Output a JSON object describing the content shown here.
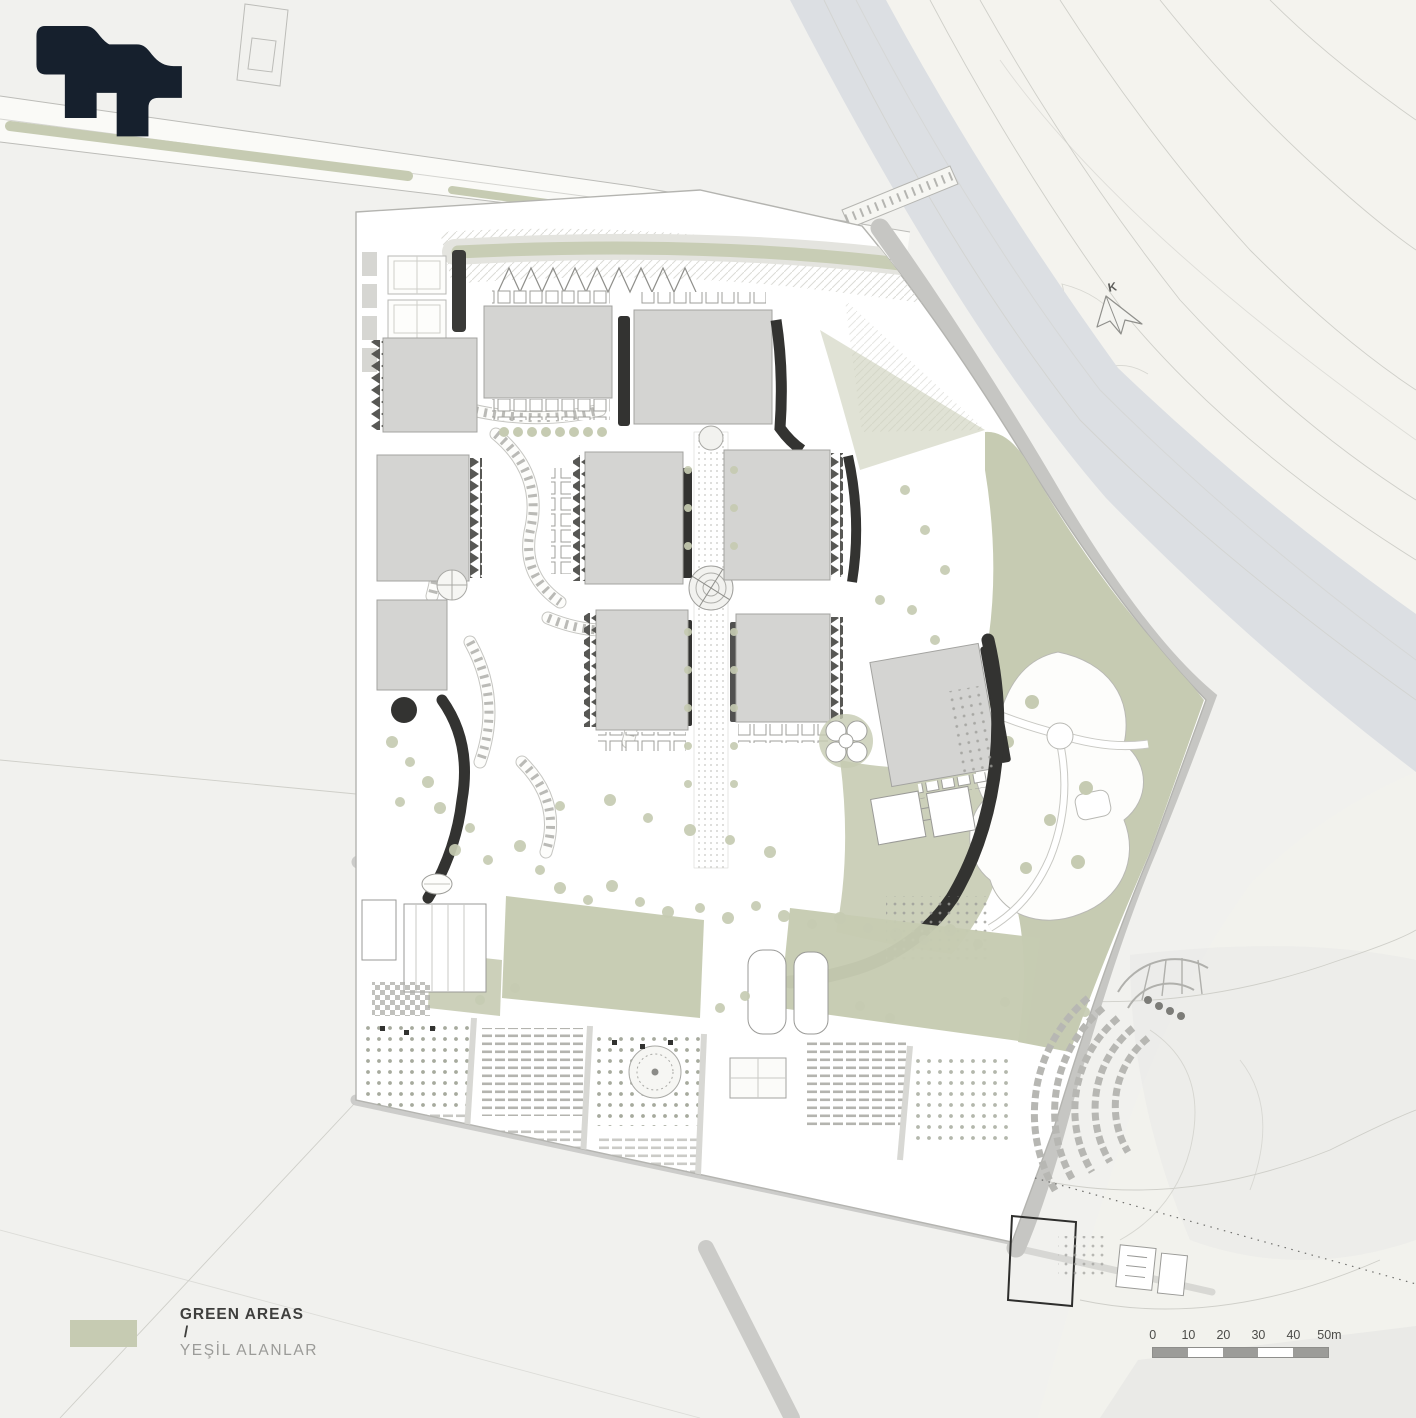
{
  "sheet": {
    "background": "#f1f1ee"
  },
  "palette": {
    "sheet_bg": "#f1f1ee",
    "logo_navy": "#16202d",
    "site_white": "#ffffff",
    "building_gray": "#d4d4d2",
    "building_outline": "#a3a3a0",
    "shadow_dark": "#333331",
    "green": "#c6cbb2",
    "road_gray": "#c6c6c3",
    "river_gray": "#dcdfe3",
    "terrain_cream": "#f4f3ee",
    "contour_line": "#cfcfc9",
    "text_dark": "#3f3f3d",
    "text_muted": "#9b9b98",
    "scale_fill": "#9c9c99"
  },
  "legend": {
    "swatch_color": "#c6cbb2",
    "label_en": "GREEN AREAS",
    "separator": "/",
    "label_tr": "YEŞİL ALANLAR"
  },
  "scale_bar": {
    "tick_labels": [
      "0",
      "10",
      "20",
      "30",
      "40",
      "50m"
    ],
    "segments": 5
  },
  "north_indicator": {
    "label": "K"
  }
}
